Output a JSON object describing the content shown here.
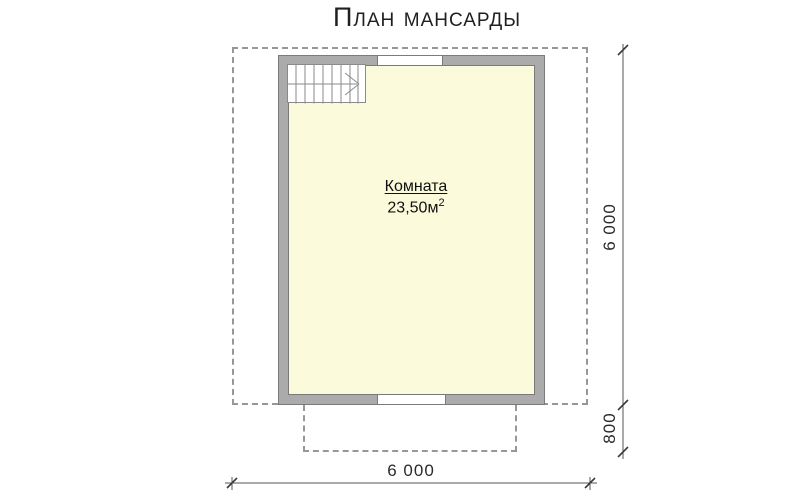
{
  "title": "План мансарды",
  "room": {
    "name": "Комната",
    "area_value": "23,50м",
    "area_sup": "2"
  },
  "dimensions": {
    "right_height": "6 000",
    "porch_depth": "800",
    "bottom_width": "6 000"
  },
  "icons": {
    "stairs": "staircase-with-direction-arrow"
  },
  "colors": {
    "wall_fill": "#ababab",
    "wall_stroke": "#7a7a7a",
    "room_fill": "#fbfbdc",
    "dash_color": "#979797",
    "dim_color": "#2b2b2b",
    "stair_line": "#8a8a8a",
    "title_color": "#1f1f1f"
  }
}
